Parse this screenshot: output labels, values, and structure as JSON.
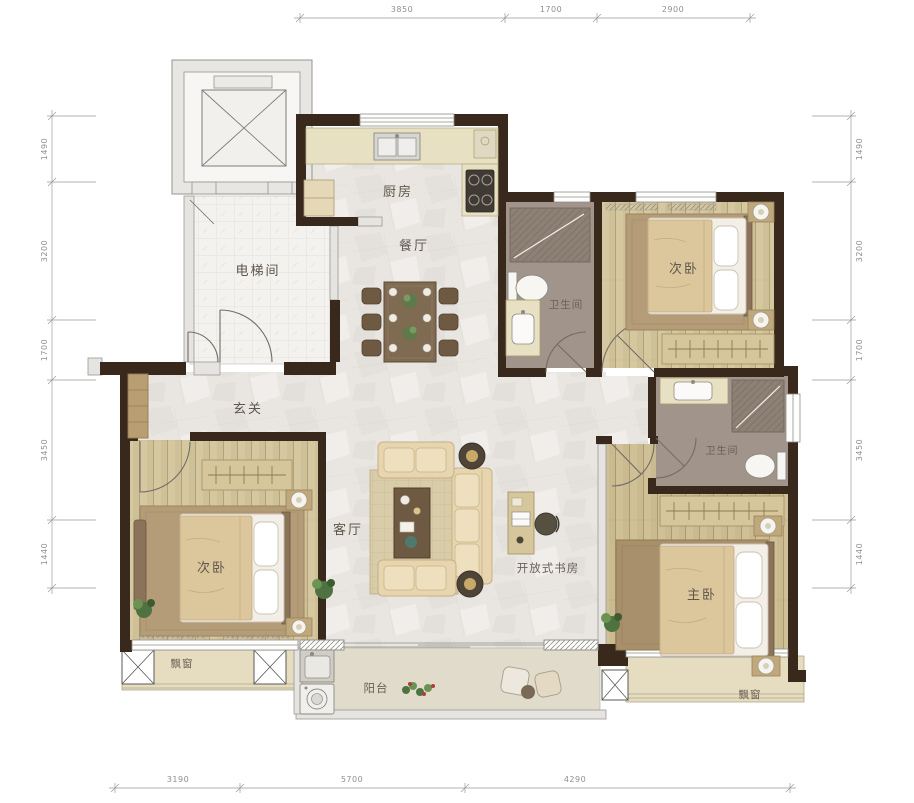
{
  "plan": {
    "rooms": {
      "kitchen": "厨房",
      "dining": "餐厅",
      "bath_top": "卫生间",
      "bedroom_tr": "次卧",
      "elevator_hall": "电梯间",
      "foyer": "玄关",
      "living": "客厅",
      "study": "开放式书房",
      "bedroom_left": "次卧",
      "master": "主卧",
      "bath_right": "卫生间",
      "bay_left": "飘窗",
      "bay_right": "飘窗",
      "balcony": "阳台"
    },
    "dimensions": {
      "top": [
        "3850",
        "1700",
        "2900"
      ],
      "bottom": [
        "3190",
        "5700",
        "4290"
      ],
      "left": [
        "1490",
        "3200",
        "1700",
        "3450",
        "1440"
      ],
      "right": [
        "1490",
        "3200",
        "1700",
        "3450",
        "1440"
      ]
    },
    "colors": {
      "wall": "#38291c",
      "light_wall": "#e6e4e1",
      "marble": "#e9e6e2",
      "wood": "#cfc197",
      "bath_floor": "#a1948a",
      "counter": "#e8e0c2",
      "bay": "#e6dcc0",
      "balcony_floor": "#e0dbcb",
      "label": "#5f574c",
      "dim": "#8f8f8f"
    }
  }
}
